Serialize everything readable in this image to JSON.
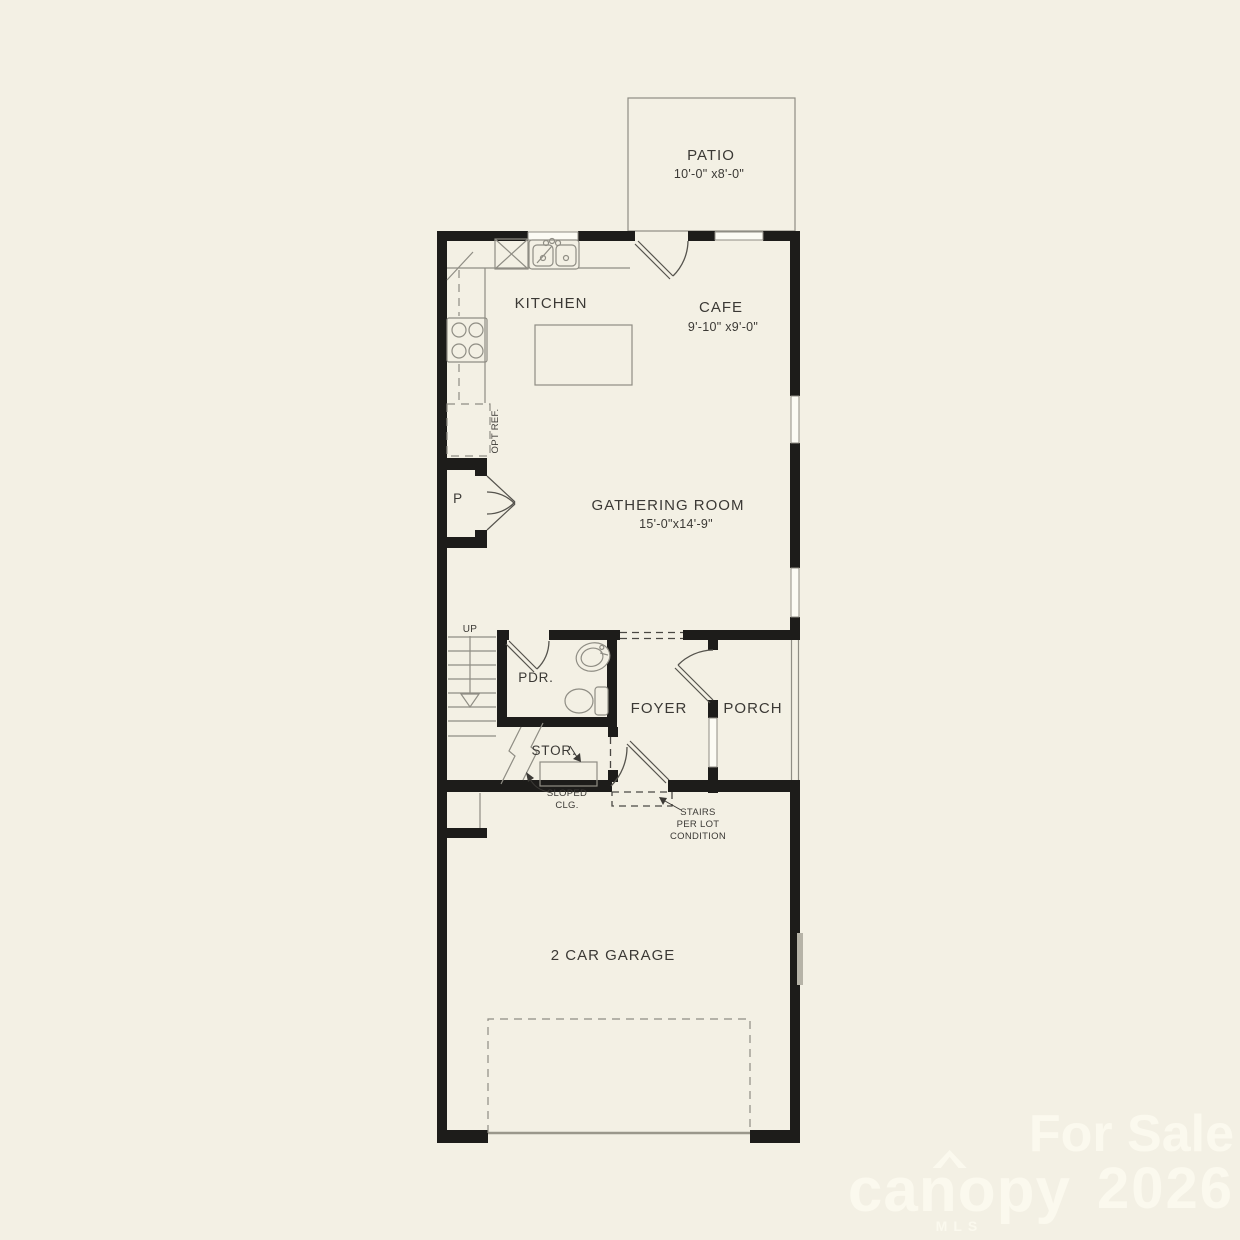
{
  "rooms": {
    "patio": {
      "label": "PATIO",
      "dims": "10'-0\" x8'-0\""
    },
    "kitchen": {
      "label": "KITCHEN"
    },
    "cafe": {
      "label": "CAFE",
      "dims": "9'-10\" x9'-0\""
    },
    "gathering_room": {
      "label": "GATHERING ROOM",
      "dims": "15'-0\"x14'-9\""
    },
    "pantry": {
      "label": "P"
    },
    "powder_room": {
      "label": "PDR."
    },
    "foyer": {
      "label": "FOYER"
    },
    "porch": {
      "label": "PORCH"
    },
    "storage": {
      "label": "STOR."
    },
    "garage": {
      "label": "2 CAR GARAGE"
    }
  },
  "annotations": {
    "stairs_up": "UP",
    "optional_refrigerator": "OPT REF.",
    "sloped_ceiling_line1": "SLOPED",
    "sloped_ceiling_line2": "CLG.",
    "stairs_note_line1": "STAIRS",
    "stairs_note_line2": "PER LOT",
    "stairs_note_line3": "CONDITION"
  },
  "watermark": {
    "status": "For Sale",
    "brand": "canopy",
    "brand_sub": "MLS",
    "year": "2026"
  },
  "colors": {
    "background": "#f3f0e4",
    "wall": "#1d1c1a",
    "thin_line": "#8f8d84",
    "label_text": "#3b3935",
    "watermark": "#fbf9ee"
  }
}
